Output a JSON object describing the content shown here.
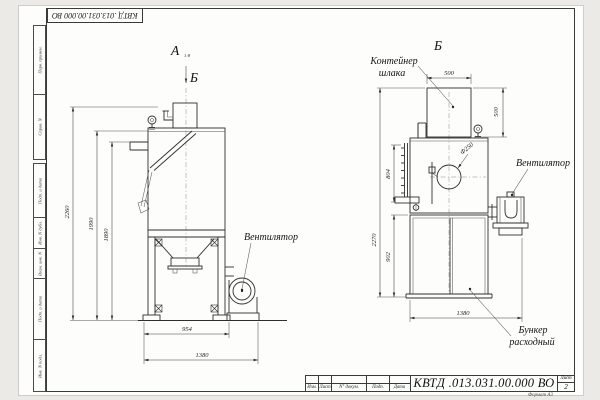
{
  "sheet": {
    "designation": "КВТД .013.031.00.000  ВО",
    "format_label": "Формат А3",
    "stamp_columns": [
      "Изм.",
      "Лист",
      "N° докум.",
      "Подп.",
      "Дата"
    ],
    "sheet_label": "Лист",
    "sheet_number": "2",
    "side_labels": {
      "perv": "Перв. примен.",
      "sprav": "Справ. N",
      "podp1": "Подп. и дата",
      "inv_dubl": "Инв. N дубл.",
      "vzam": "Взам. инв. N",
      "podp2": "Подп. и дата",
      "inv_podl": "Инв. N подл."
    }
  },
  "view_a": {
    "label": "А",
    "scale": "1:8",
    "section_arrow": "Б",
    "fan_label": "Вентилятор",
    "dims": {
      "h_total": "2260",
      "h_body": "1990",
      "h_stub": "1890",
      "w_frame": "954",
      "w_total": "1380"
    }
  },
  "view_b": {
    "label": "Б",
    "container_line1": "Контейнер",
    "container_line2": "шлака",
    "fan_label": "Вентилятор",
    "bunker_line1": "Бункер",
    "bunker_line2": "расходный",
    "dims": {
      "container_w": "500",
      "container_h": "500",
      "hole_d": "Ф250",
      "ladder_h": "804",
      "h_total": "2270",
      "bunker_h": "902",
      "depth": "1380"
    }
  }
}
